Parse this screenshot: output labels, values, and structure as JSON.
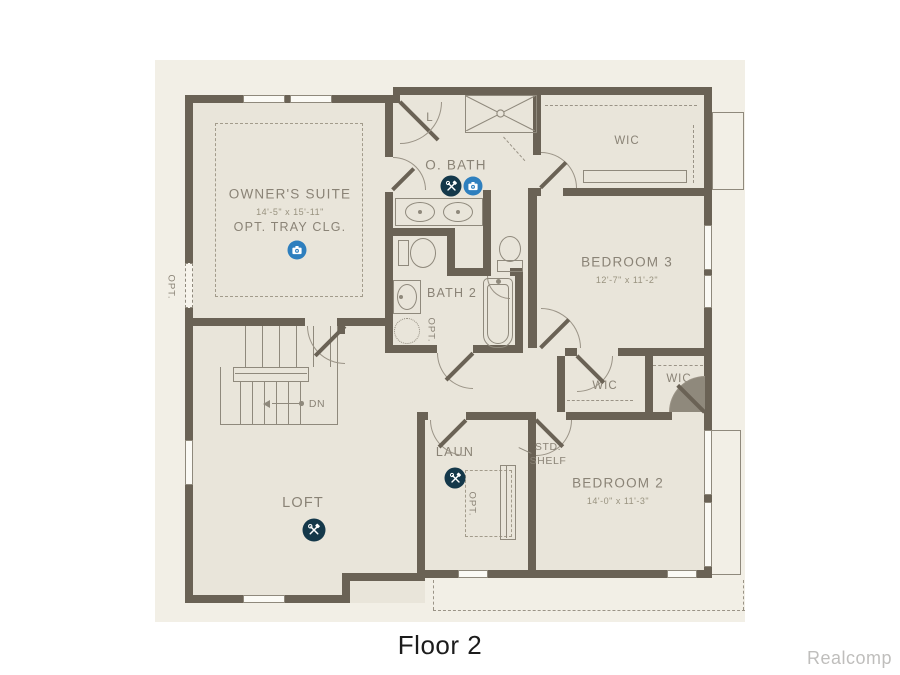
{
  "footer": {
    "caption": "Floor 2",
    "watermark": "Realcomp"
  },
  "rooms": {
    "owners_suite": {
      "label": "OWNER'S SUITE",
      "dims": "14'-5\" x 15'-11\"",
      "note": "OPT. TRAY CLG."
    },
    "o_bath": {
      "label": "O. BATH"
    },
    "linen_closet": {
      "label": "L"
    },
    "wic_top": {
      "label": "WIC"
    },
    "bedroom_3": {
      "label": "BEDROOM 3",
      "dims": "12'-7\" x 11'-2\""
    },
    "bath_2": {
      "label": "BATH 2"
    },
    "wic_left": {
      "label": "WIC"
    },
    "wic_right": {
      "label": "WIC"
    },
    "bedroom_2": {
      "label": "BEDROOM 2",
      "dims": "14'-0\" x 11'-3\""
    },
    "laundry": {
      "label": "LAUN"
    },
    "loft": {
      "label": "LOFT"
    }
  },
  "annotations": {
    "down": "DN",
    "opt_window": "OPT.",
    "opt_tub": "OPT.",
    "opt_cabinet": "OPT.",
    "std_shelf_line1": "STD.",
    "std_shelf_line2": "SHELF"
  },
  "icons": {
    "camera": "camera-icon",
    "tools": "tools-icon"
  },
  "colors": {
    "canvas": "#f2efe6",
    "room": "#e9e5da",
    "wall": "#6a6255",
    "line": "#8f897c",
    "label": "#8a8376",
    "camera_blue": "#2e7fbe",
    "tools_navy": "#14384a"
  }
}
